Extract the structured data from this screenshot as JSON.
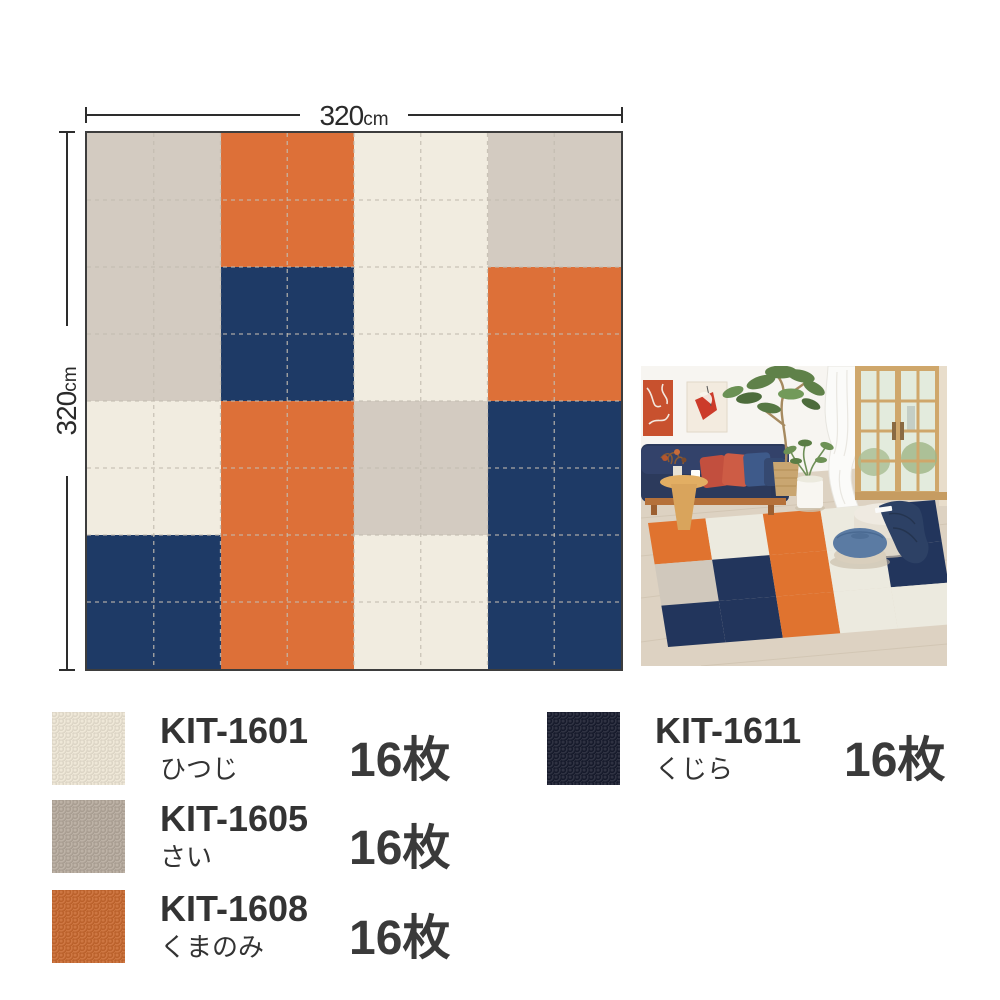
{
  "diagram": {
    "width_label": {
      "value": "320",
      "unit": "cm"
    },
    "height_label": {
      "value": "320",
      "unit": "cm"
    },
    "grid": {
      "rows": 8,
      "cols": 8
    },
    "grid_line_color": "#c3bcb1",
    "border_color": "#3d3d3d",
    "palette": {
      "cream": "#F1ECE0",
      "gray": "#D3CBC1",
      "orange": "#DD7038",
      "navy": "#1E3A66"
    },
    "blocks": [
      [
        "gray",
        "orange",
        "cream",
        "gray"
      ],
      [
        "gray",
        "navy",
        "cream",
        "orange"
      ],
      [
        "cream",
        "orange",
        "gray",
        "navy"
      ],
      [
        "navy",
        "orange",
        "cream",
        "navy"
      ]
    ]
  },
  "legend": {
    "items": [
      {
        "code": "KIT-1601",
        "name": "ひつじ",
        "count": "16枚",
        "hex": "#EDE5D4",
        "palette_key": "cream"
      },
      {
        "code": "KIT-1605",
        "name": "さい",
        "count": "16枚",
        "hex": "#B5A99C",
        "palette_key": "gray"
      },
      {
        "code": "KIT-1608",
        "name": "くまのみ",
        "count": "16枚",
        "hex": "#C8682E",
        "palette_key": "orange"
      },
      {
        "code": "KIT-1611",
        "name": "くじら",
        "count": "16枚",
        "hex": "#181C2E",
        "palette_key": "navy"
      }
    ]
  },
  "photo_palette": {
    "wall": "#f7f5f1",
    "floor": "#ddd2c2",
    "sofa": "#2c3a5c",
    "sofa_wood": "#b5713a",
    "door_wood": "#cfa76b",
    "rug_cream": "#ECEADF",
    "rug_orange": "#E0732F",
    "rug_navy": "#22355C",
    "rug_gray": "#D0C8BC"
  }
}
